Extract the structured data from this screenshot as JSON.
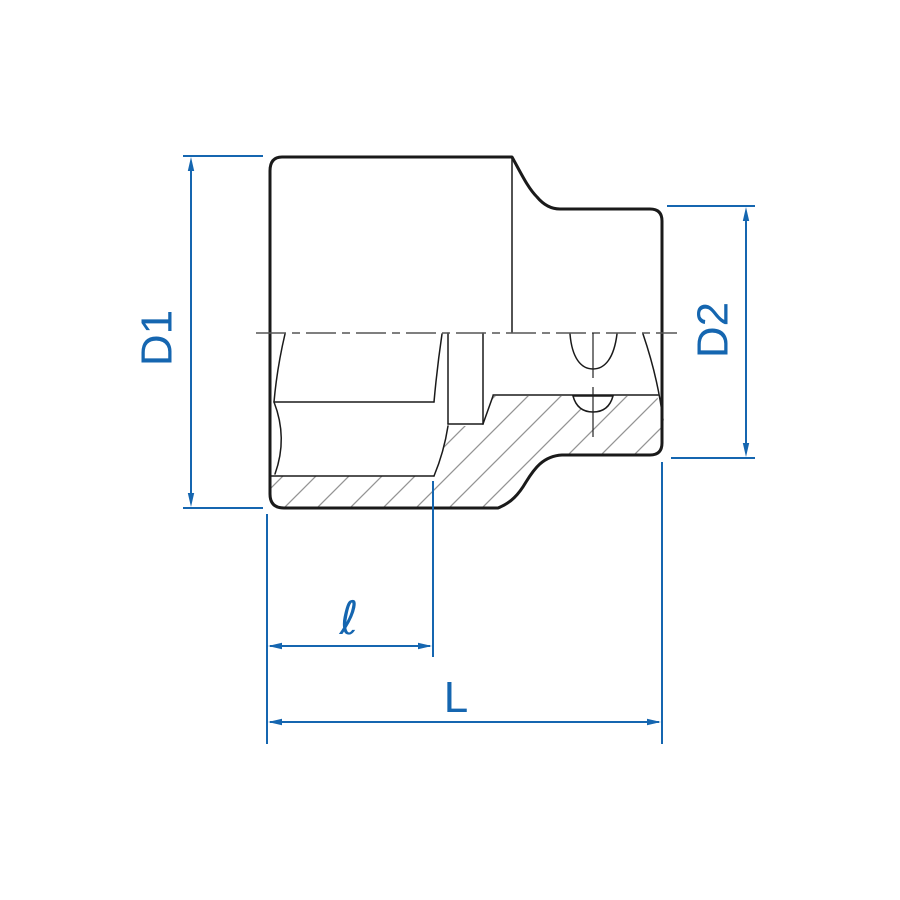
{
  "drawing": {
    "type": "technical-dimension-drawing",
    "subject": "socket cross-section with half section view",
    "labels": {
      "d1": "D1",
      "d2": "D2",
      "l_small": "ℓ",
      "l_total": "L"
    }
  },
  "colors": {
    "dimension_blue": "#1566b0",
    "outline_black": "#1a1a1a",
    "hatch_gray": "#949494",
    "centerline_gray": "#555555",
    "background": "#ffffff"
  }
}
